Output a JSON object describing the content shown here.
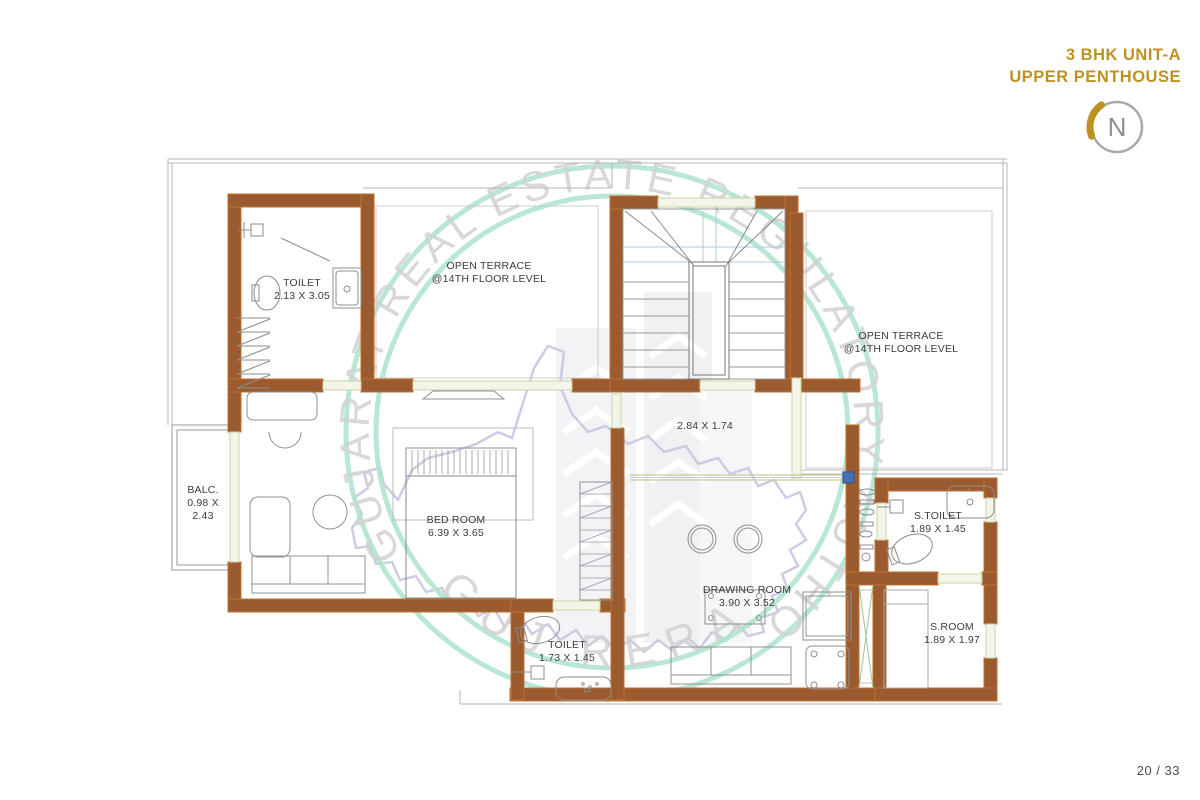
{
  "header": {
    "title_line1": "3 BHK UNIT-A",
    "title_line2": "UPPER PENTHOUSE"
  },
  "north": {
    "label": "N"
  },
  "watermark": {
    "ring_text": "GUJARAT REAL ESTATE REGULATORY AUTHORITY",
    "bottom_text": "GUJ RERA"
  },
  "rooms": {
    "toilet1": {
      "name": "TOILET",
      "dims": "2.13 X 3.05"
    },
    "terrace_left": {
      "name": "OPEN TERRACE",
      "dims": "@14TH FLOOR LEVEL"
    },
    "terrace_right": {
      "name": "OPEN TERRACE",
      "dims": "@14TH FLOOR LEVEL"
    },
    "balcony": {
      "name": "BALC.",
      "dims_l1": "0.98 X",
      "dims_l2": "2.43"
    },
    "bedroom": {
      "name": "BED ROOM",
      "dims": "6.39 X 3.65"
    },
    "passage": {
      "dims": "2.84 X 1.74"
    },
    "s_toilet": {
      "name": "S.TOILET",
      "dims": "1.89 X 1.45"
    },
    "drawing_room": {
      "name": "DRAWING ROOM",
      "dims": "3.90 X 3.52"
    },
    "s_room": {
      "name": "S.ROOM",
      "dims": "1.89 X 1.97"
    },
    "toilet2": {
      "name": "TOILET",
      "dims": "1.73 X 1.45"
    }
  },
  "footer": {
    "page_indicator": "20 / 33"
  },
  "colors": {
    "accent_gold": "#be9222",
    "wall_brown": "#9c5b2e",
    "watermark_green": "#ace3cc"
  }
}
